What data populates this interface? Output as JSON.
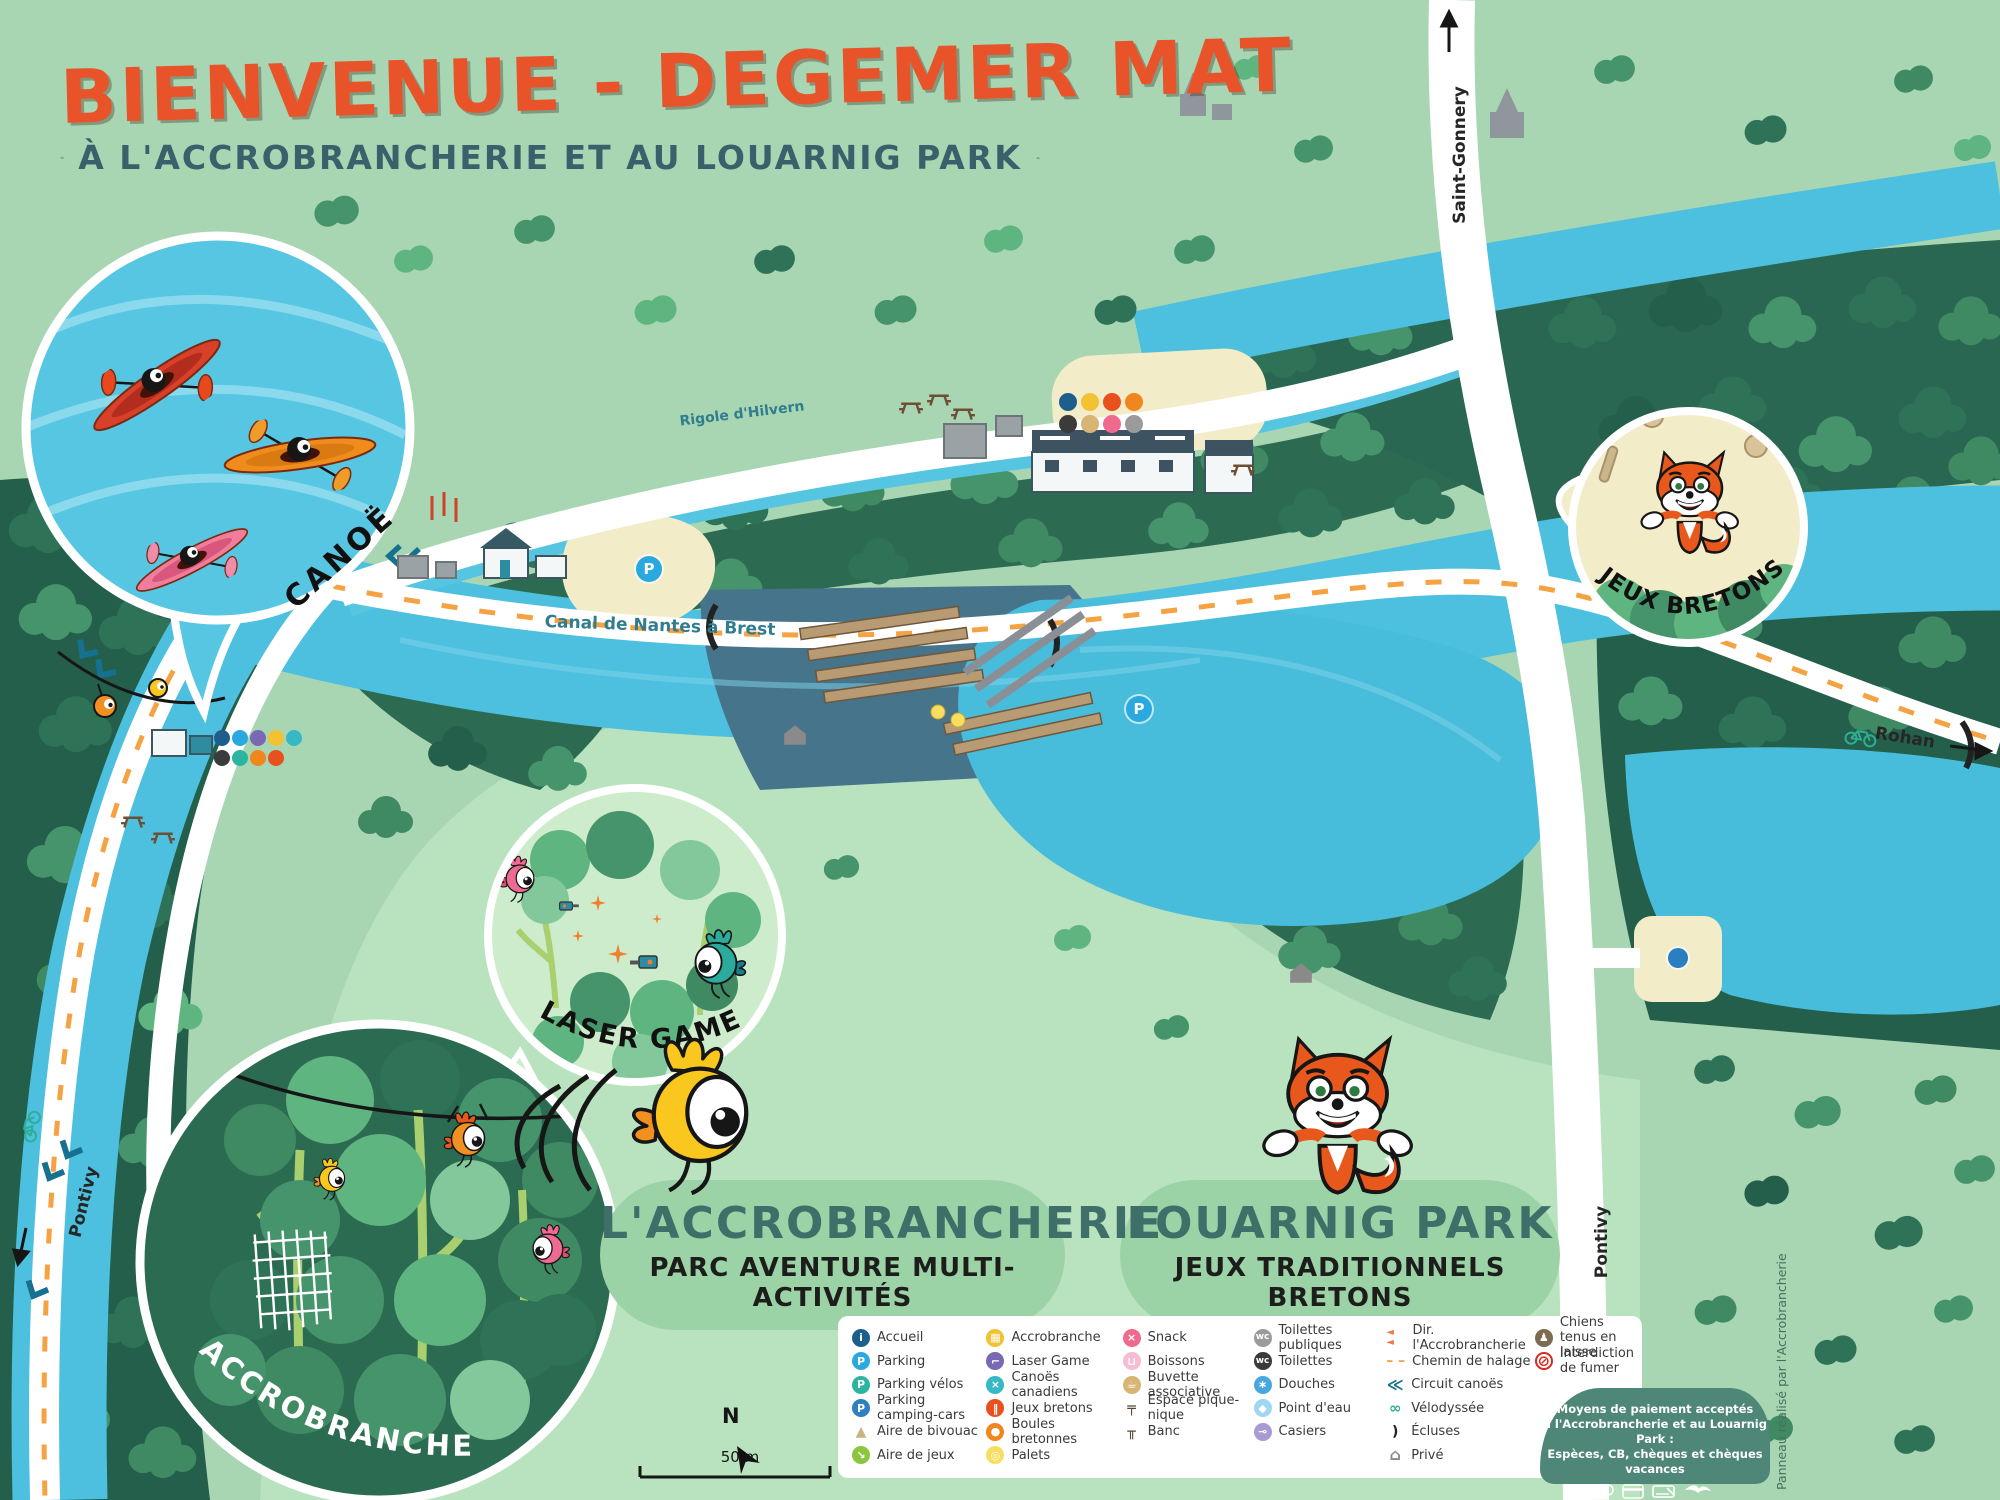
{
  "header": {
    "title": "BIENVENUE - DEGEMER MAT",
    "subtitle": "À L'ACCROBRANCHERIE ET AU LOUARNIG PARK"
  },
  "insets": {
    "canoe": {
      "label": "CANOË"
    },
    "laser_game": {
      "label": "LASER GAME"
    },
    "accrobranche": {
      "label": "ACCROBRANCHE"
    },
    "jeux_bretons": {
      "label": "JEUX BRETONS"
    }
  },
  "areas": {
    "accrobrancherie": {
      "name": "L'ACCROBRANCHERIE",
      "tagline": "PARC AVENTURE MULTI-ACTIVITÉS"
    },
    "louarnig": {
      "name": "LOUARNIG PARK",
      "tagline": "JEUX TRADITIONNELS BRETONS"
    }
  },
  "map_labels": {
    "canal": "Canal de Nantes à Brest",
    "rigole": "Rigole d'Hilvern",
    "road_top": "Saint-Gonnery",
    "road_right": "Rohan",
    "road_left": "Pontivy",
    "road_bottom": "Pontivy"
  },
  "map": {
    "parking_glyph": "P"
  },
  "compass": {
    "north": "N",
    "scale": "50 m"
  },
  "legend": {
    "cols": [
      [
        {
          "label": "Accueil",
          "glyph": "i",
          "bg": "#1d5e8d",
          "fg": "#ffffff",
          "shape": "c"
        },
        {
          "label": "Parking",
          "glyph": "P",
          "bg": "#2aa9e0",
          "fg": "#ffffff",
          "shape": "c"
        },
        {
          "label": "Parking vélos",
          "glyph": "P",
          "bg": "#2bb5a0",
          "fg": "#ffffff",
          "shape": "c"
        },
        {
          "label": "Parking camping-cars",
          "glyph": "P",
          "bg": "#2f7fc1",
          "fg": "#ffffff",
          "shape": "c"
        },
        {
          "label": "Aire de bivouac",
          "glyph": "▲",
          "bg": "",
          "fg": "#c9b384",
          "shape": "p"
        },
        {
          "label": "Aire de jeux",
          "glyph": "↘",
          "bg": "#8cc63e",
          "fg": "#ffffff",
          "shape": "c"
        }
      ],
      [
        {
          "label": "Accrobranche",
          "glyph": "▦",
          "bg": "#f2c233",
          "fg": "#ffffff",
          "shape": "c"
        },
        {
          "label": "Laser Game",
          "glyph": "⌐",
          "bg": "#7a68b4",
          "fg": "#ffffff",
          "shape": "c"
        },
        {
          "label": "Canoës canadiens",
          "glyph": "×",
          "bg": "#36b9c5",
          "fg": "#ffffff",
          "shape": "c"
        },
        {
          "label": "Jeux bretons",
          "glyph": "‖",
          "bg": "#e8501e",
          "fg": "#ffffff",
          "shape": "c"
        },
        {
          "label": "Boules bretonnes",
          "glyph": "●",
          "bg": "#f0861e",
          "fg": "#ffffff",
          "shape": "c"
        },
        {
          "label": "Palets",
          "glyph": "◎",
          "bg": "#f7dd60",
          "fg": "#ffffff",
          "shape": "c"
        }
      ],
      [
        {
          "label": "Snack",
          "glyph": "×",
          "bg": "#ef6a8e",
          "fg": "#ffffff",
          "shape": "c"
        },
        {
          "label": "Boissons",
          "glyph": "⊔",
          "bg": "#f6bcd2",
          "fg": "#ffffff",
          "shape": "c"
        },
        {
          "label": "Buvette associative",
          "glyph": "☕",
          "bg": "#d8b475",
          "fg": "#ffffff",
          "shape": "c"
        },
        {
          "label": "Espace pique-nique",
          "glyph": "╤",
          "bg": "",
          "fg": "#5a4632",
          "shape": "p"
        },
        {
          "label": "Banc",
          "glyph": "╥",
          "bg": "",
          "fg": "#5a4632",
          "shape": "p"
        }
      ],
      [
        {
          "label": "Toilettes publiques",
          "glyph": "wc",
          "bg": "#9b9b9b",
          "fg": "#ffffff",
          "shape": "c"
        },
        {
          "label": "Toilettes",
          "glyph": "wc",
          "bg": "#3b3b3b",
          "fg": "#ffffff",
          "shape": "c"
        },
        {
          "label": "Douches",
          "glyph": "∗",
          "bg": "#47a8e0",
          "fg": "#ffffff",
          "shape": "c"
        },
        {
          "label": "Point d'eau",
          "glyph": "◆",
          "bg": "#9fd6f2",
          "fg": "#ffffff",
          "shape": "c"
        },
        {
          "label": "Casiers",
          "glyph": "⊸",
          "bg": "#a89bd4",
          "fg": "#ffffff",
          "shape": "c"
        }
      ],
      [
        {
          "label": "Dir. l'Accrobrancherie",
          "glyph": "◄ ◄",
          "bg": "",
          "fg": "#ef7b4a",
          "shape": "p"
        },
        {
          "label": "Chemin de halage",
          "glyph": "– –",
          "bg": "",
          "fg": "#f5a243",
          "shape": "p"
        },
        {
          "label": "Circuit canoës",
          "glyph": "≪",
          "bg": "",
          "fg": "#15718f",
          "shape": "p"
        },
        {
          "label": "Vélodyssée",
          "glyph": "∞",
          "bg": "",
          "fg": "#2fae96",
          "shape": "p"
        },
        {
          "label": "Écluses",
          "glyph": ")",
          "bg": "",
          "fg": "#222222",
          "shape": "p"
        },
        {
          "label": "Privé",
          "glyph": "⌂",
          "bg": "",
          "fg": "#8a8a8a",
          "shape": "p"
        }
      ],
      [
        {
          "label": "Chiens tenus en laisse",
          "glyph": "♟",
          "bg": "#7d6b52",
          "fg": "#ffffff",
          "shape": "c"
        },
        {
          "label": "Interdiction de fumer",
          "glyph": "⊘",
          "bg": "#ffffff",
          "fg": "#d42b1e",
          "shape": "c"
        }
      ]
    ]
  },
  "payment": {
    "line1": "Moyens de paiement acceptés",
    "line2": "à l'Accrobrancherie et au Louarnig Park :",
    "line3": "Espèces, CB, chèques et chèques vacances"
  },
  "credit": "Panneau réalisé par l'Accrobrancherie",
  "colors": {
    "background": "#a9d6b2",
    "field": "#b9e2bf",
    "forest_dark": "#235f4a",
    "water": "#4cc0de",
    "sand": "#f2ecc8",
    "road": "#ffffff",
    "title_orange": "#e8532a",
    "heading_teal": "#3f6f68",
    "payment_bg": "#4e8677",
    "towpath_dash": "#f5a243"
  }
}
